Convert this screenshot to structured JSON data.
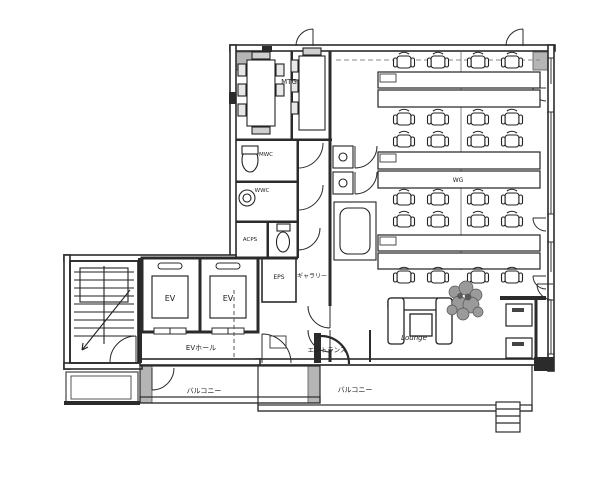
{
  "meta": {
    "type": "architectural-floor-plan",
    "floor_use": "office"
  },
  "palette": {
    "paper": "#ffffff",
    "line": "#2b2b2b",
    "column_gray": "#b5b5b5"
  },
  "labels": {
    "mtg": "MTG",
    "mwc": "MWC",
    "wwc": "WWC",
    "acps": "ACPS",
    "eps": "EPS",
    "gallery": "ギャラリー",
    "elevator_1": "EV",
    "elevator_2": "EV",
    "ev_hall": "EVホール",
    "entrance": "エントランス",
    "balcony_left": "バルコニー",
    "balcony_right": "バルコニー",
    "desk_island": "WG",
    "lounge": "Lounge"
  }
}
